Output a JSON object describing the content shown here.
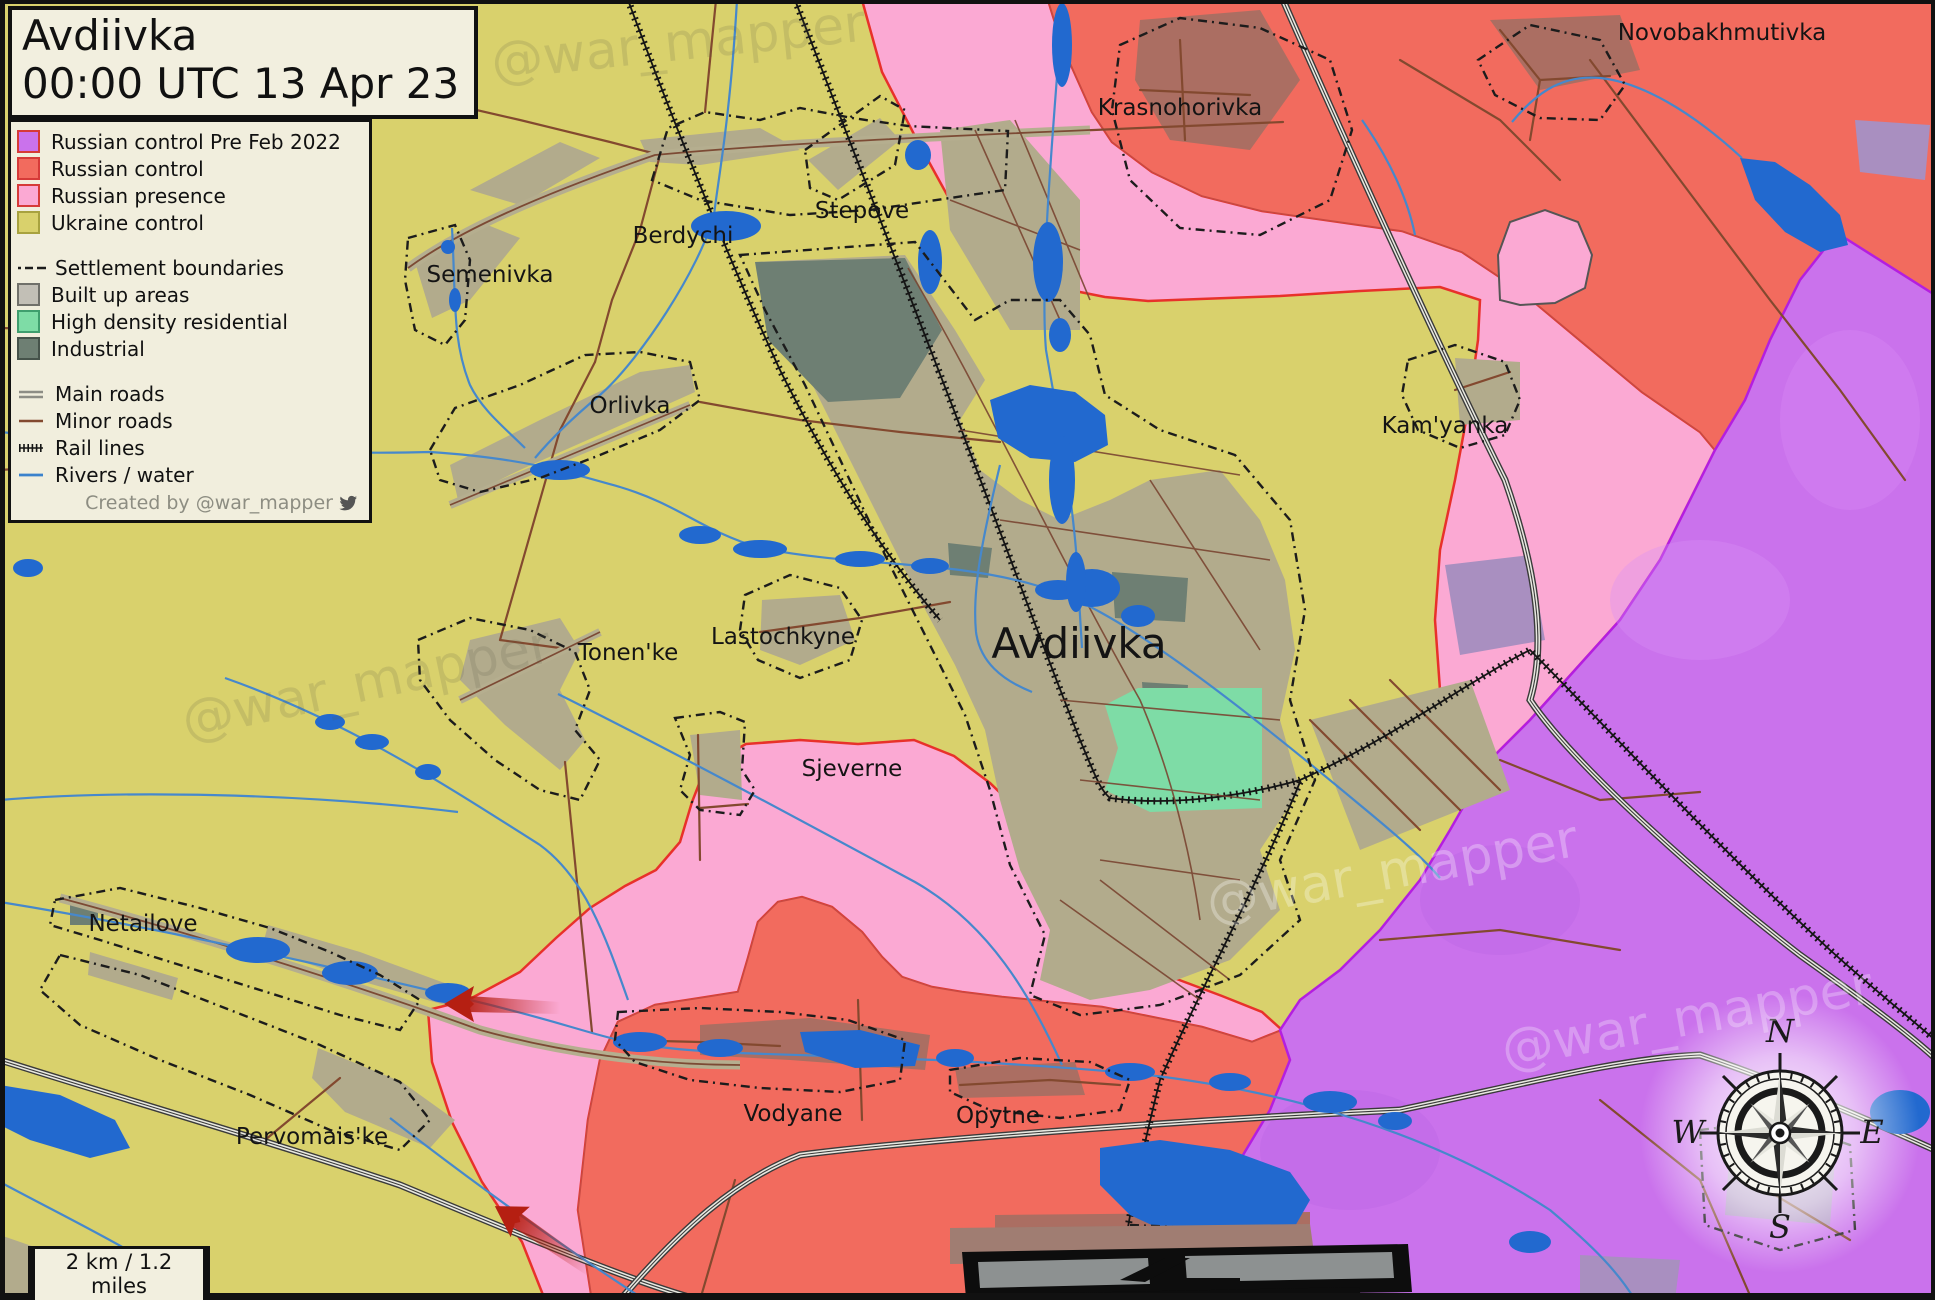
{
  "title": {
    "line1": "Avdiivka",
    "line2": "00:00 UTC 13 Apr 23"
  },
  "legend": {
    "control_items": [
      {
        "label": "Russian control Pre Feb 2022",
        "color": "#ca72ec"
      },
      {
        "label": "Russian control",
        "color": "#f26b5e"
      },
      {
        "label": "Russian presence",
        "color": "#fba9d3"
      },
      {
        "label": "Ukraine control",
        "color": "#d9d16c"
      }
    ],
    "area_items": [
      {
        "label": "Settlement boundaries"
      },
      {
        "label": "Built up areas",
        "color": "#c2bfb6"
      },
      {
        "label": "High density residential",
        "color": "#7edca6"
      },
      {
        "label": "Industrial",
        "color": "#6e7f73"
      }
    ],
    "line_items": [
      {
        "label": "Main roads"
      },
      {
        "label": "Minor roads"
      },
      {
        "label": "Rail lines"
      },
      {
        "label": "Rivers / water"
      }
    ],
    "credit": "Created by @war_mapper"
  },
  "map": {
    "colors": {
      "ukraine": "#d9d16c",
      "russian": "#f26b5e",
      "presence": "#fba9d3",
      "pre2022": "#ca72ec",
      "pre2022_border": "#b41ee0",
      "frontline": "#e8312a",
      "water": "#2269cf",
      "builtup": "#b2ab8c",
      "industrial": "#6e7f73",
      "residential": "#7edca6"
    },
    "labels": [
      {
        "text": "Berdychi",
        "x": 683,
        "y": 243,
        "size": 23
      },
      {
        "text": "Stepove",
        "x": 862,
        "y": 218,
        "size": 23
      },
      {
        "text": "Semenivka",
        "x": 490,
        "y": 282,
        "size": 23
      },
      {
        "text": "Krasnohorivka",
        "x": 1180,
        "y": 115,
        "size": 23
      },
      {
        "text": "Novobakhmutivka",
        "x": 1722,
        "y": 40,
        "size": 23
      },
      {
        "text": "Kam'yanka",
        "x": 1445,
        "y": 433,
        "size": 23
      },
      {
        "text": "Orlivka",
        "x": 630,
        "y": 413,
        "size": 23
      },
      {
        "text": "Tonen'ke",
        "x": 628,
        "y": 660,
        "size": 23
      },
      {
        "text": "Lastochkyne",
        "x": 783,
        "y": 644,
        "size": 23
      },
      {
        "text": "Avdiivka",
        "x": 1079,
        "y": 658,
        "size": 42
      },
      {
        "text": "Sjeverne",
        "x": 852,
        "y": 776,
        "size": 23
      },
      {
        "text": "Netailove",
        "x": 143,
        "y": 931,
        "size": 23
      },
      {
        "text": "Pervomais'ke",
        "x": 312,
        "y": 1144,
        "size": 23
      },
      {
        "text": "Vodyane",
        "x": 793,
        "y": 1121,
        "size": 23
      },
      {
        "text": "Opytne",
        "x": 998,
        "y": 1123,
        "size": 23
      }
    ]
  },
  "watermark": {
    "text": "@war_mapper"
  },
  "scale_bar": {
    "label": "2 km / 1.2 miles"
  },
  "compass": {
    "n": "N",
    "e": "E",
    "s": "S",
    "w": "W"
  }
}
